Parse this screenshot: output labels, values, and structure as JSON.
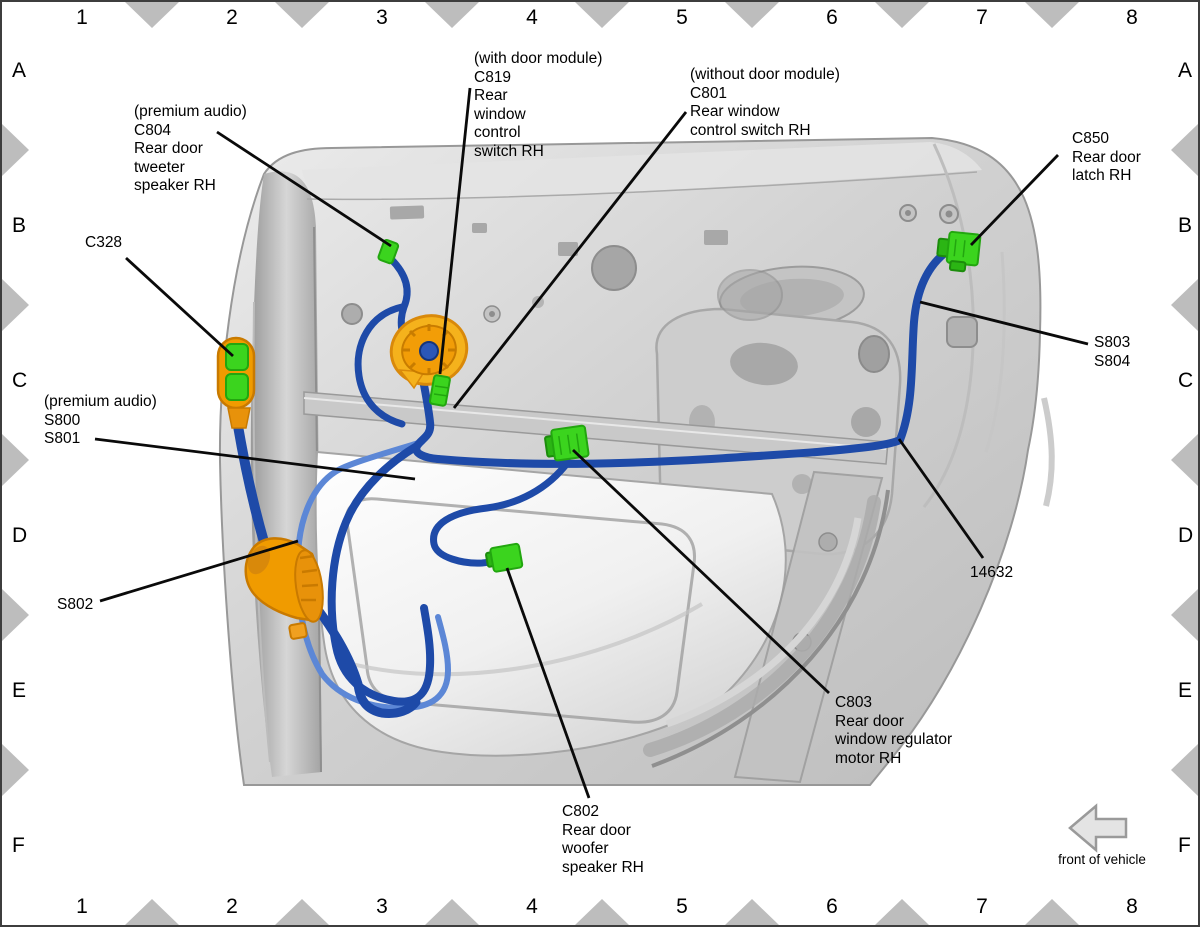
{
  "grid": {
    "columns": [
      "1",
      "2",
      "3",
      "4",
      "5",
      "6",
      "7",
      "8"
    ],
    "rows": [
      "A",
      "B",
      "C",
      "D",
      "E",
      "F"
    ]
  },
  "front_arrow": {
    "label": "front of vehicle"
  },
  "callouts": [
    {
      "id": "c804",
      "x": 132,
      "y": 101,
      "lines": [
        "(premium audio)",
        "C804",
        "Rear door",
        "tweeter",
        "speaker RH"
      ],
      "leader": [
        215,
        130,
        389,
        244
      ]
    },
    {
      "id": "c819",
      "x": 472,
      "y": 48,
      "lines": [
        "(with door module)",
        "C819",
        "Rear",
        "window",
        "control",
        "switch RH"
      ],
      "leader": [
        468,
        86,
        438,
        372
      ]
    },
    {
      "id": "c801",
      "x": 688,
      "y": 64,
      "lines": [
        "(without door module)",
        "C801",
        "Rear window",
        "control switch RH"
      ],
      "leader": [
        684,
        110,
        452,
        406
      ]
    },
    {
      "id": "c850",
      "x": 1070,
      "y": 128,
      "lines": [
        "C850",
        "Rear door",
        "latch RH"
      ],
      "leader": [
        1056,
        153,
        969,
        243
      ]
    },
    {
      "id": "c328",
      "x": 83,
      "y": 232,
      "lines": [
        "C328"
      ],
      "leader": [
        124,
        256,
        231,
        354
      ]
    },
    {
      "id": "s800-s801",
      "x": 42,
      "y": 391,
      "lines": [
        "(premium audio)",
        "S800",
        "S801"
      ],
      "leader": [
        93,
        437,
        413,
        477
      ]
    },
    {
      "id": "s802",
      "x": 55,
      "y": 594,
      "lines": [
        "S802"
      ],
      "leader": [
        98,
        599,
        296,
        539
      ]
    },
    {
      "id": "s803-s804",
      "x": 1092,
      "y": 332,
      "lines": [
        "S803",
        "S804"
      ],
      "leader": [
        1086,
        342,
        918,
        300
      ]
    },
    {
      "id": "part-14632",
      "x": 968,
      "y": 562,
      "lines": [
        "14632"
      ],
      "leader": [
        981,
        556,
        897,
        437
      ]
    },
    {
      "id": "c803",
      "x": 833,
      "y": 692,
      "lines": [
        "C803",
        "Rear door",
        "window regulator",
        "motor RH"
      ],
      "leader": [
        827,
        691,
        571,
        448
      ]
    },
    {
      "id": "c802",
      "x": 560,
      "y": 801,
      "lines": [
        "C802",
        "Rear door",
        "woofer",
        "speaker RH"
      ],
      "leader": [
        587,
        796,
        505,
        566
      ]
    }
  ],
  "colors": {
    "wire_dark": "#1e4aa8",
    "wire_light": "#5c87d6",
    "connector_green": "#3bd41e",
    "connector_green_dark": "#22a60f",
    "grommet_orange": "#f09b00",
    "grommet_orange_dark": "#c97a00",
    "leader_black": "#0a0a0a",
    "triangle_gray": "#bdbdbd",
    "panel_gray": "#cfcfcf"
  }
}
